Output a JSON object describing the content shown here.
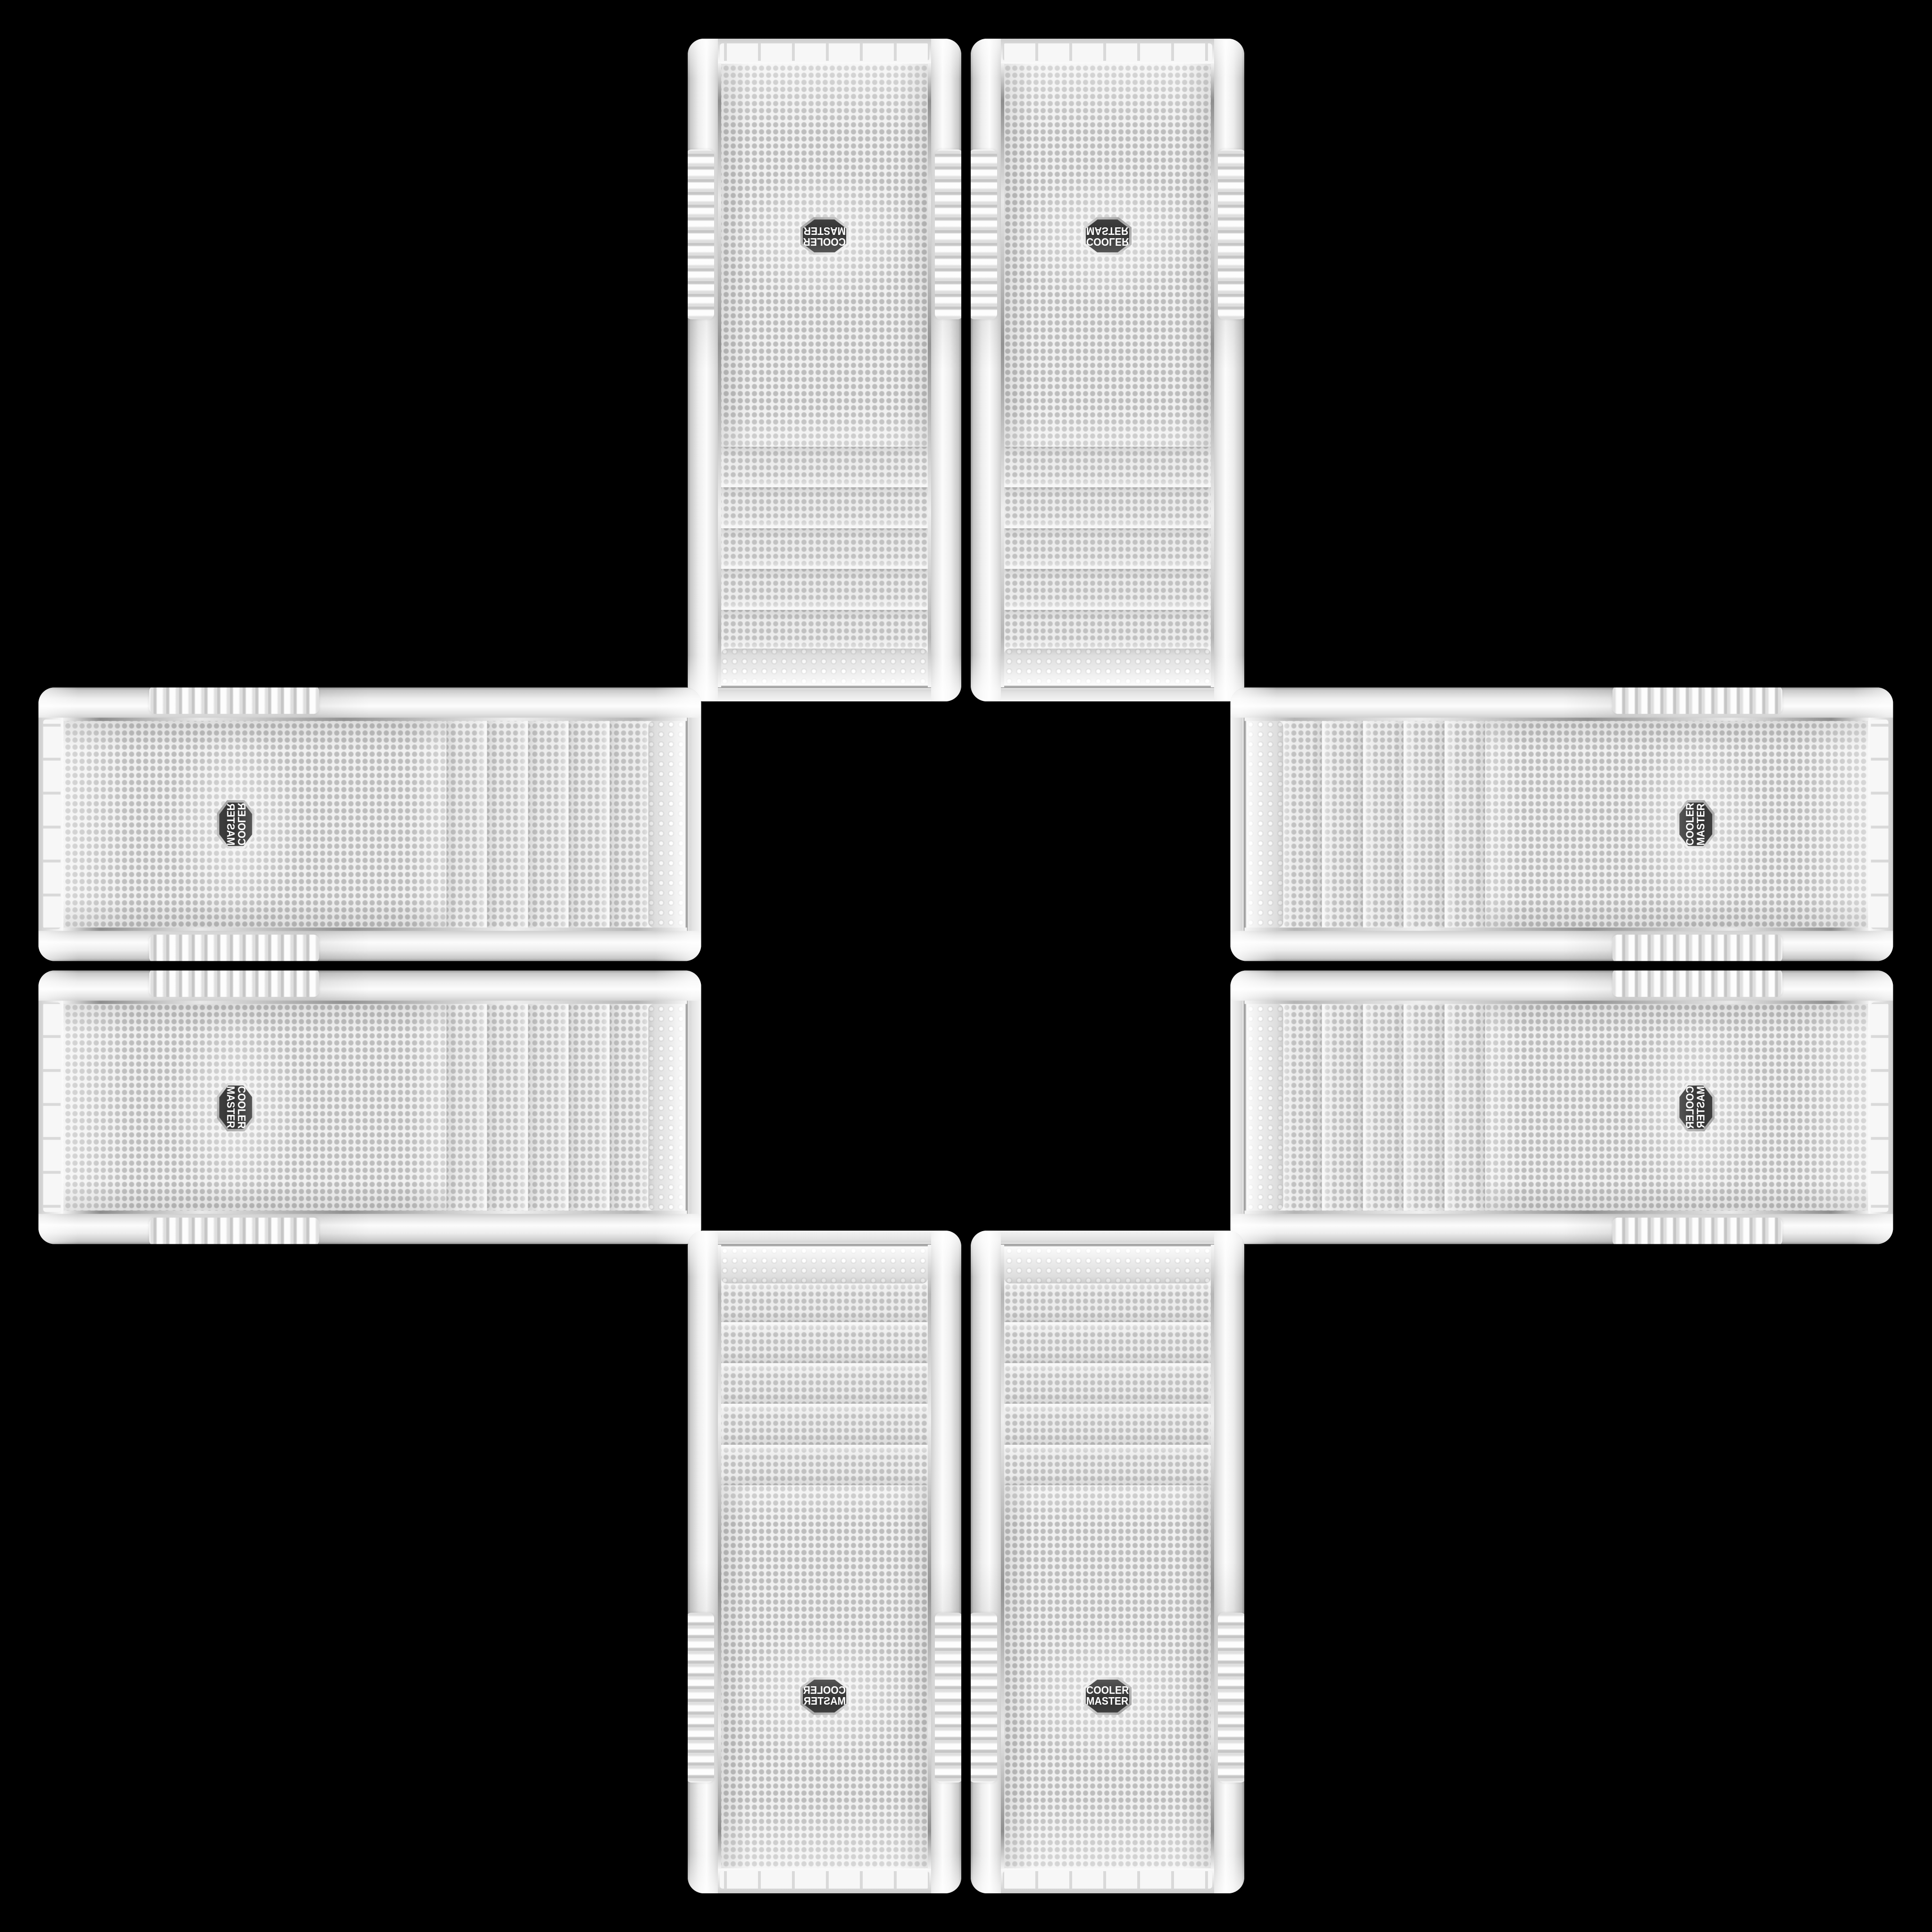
{
  "scene": {
    "background_color": "#000000",
    "layout": "plus-cross arrangement of 8 identical white Cooler Master tower PC cases, front panels facing viewer, logo ends pointing outward, center empty"
  },
  "brand": {
    "line1": "COOLER",
    "line2": "MASTER"
  },
  "colors": {
    "background": "#000000",
    "case_plastic": "#f0f0f0",
    "case_shadow": "#9a9a9a",
    "mesh_base": "#f0f0f0",
    "mesh_dot": "#bdbdbd",
    "chrome_trim": "#8f8f8f",
    "badge_face": "#3a3a3a",
    "badge_rim": "#cccccc",
    "badge_text": "#ffffff"
  },
  "cases": [
    {
      "id": "top-left",
      "orientation": "vertical",
      "rotation": "rotated-180"
    },
    {
      "id": "top-right",
      "orientation": "vertical",
      "rotation": "flipped-vertical"
    },
    {
      "id": "left-top",
      "orientation": "horizontal",
      "rotation": "rotated-90-mirrored"
    },
    {
      "id": "left-bottom",
      "orientation": "horizontal",
      "rotation": "rotated-90"
    },
    {
      "id": "right-top",
      "orientation": "horizontal",
      "rotation": "rotated-270"
    },
    {
      "id": "right-bottom",
      "orientation": "horizontal",
      "rotation": "rotated-270-mirrored"
    },
    {
      "id": "bottom-left",
      "orientation": "vertical",
      "rotation": "flipped-horizontal"
    },
    {
      "id": "bottom-right",
      "orientation": "vertical",
      "rotation": "upright"
    }
  ]
}
